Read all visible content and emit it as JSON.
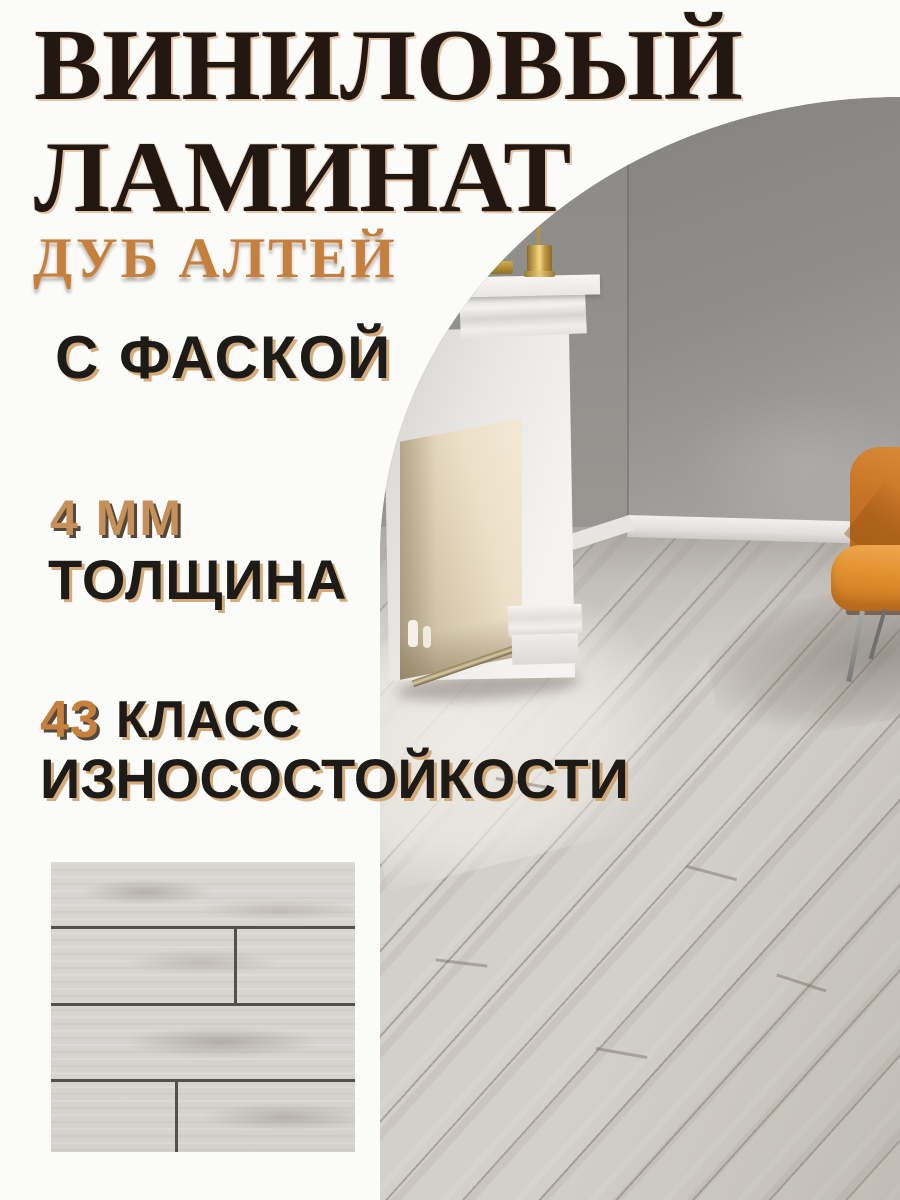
{
  "page": {
    "background": "#fbfbfa"
  },
  "title": {
    "line1": "ВИНИЛОВЫЙ",
    "line2": "ЛАМИНАТ"
  },
  "subtitle": {
    "text": "ДУБ АЛТЕЙ"
  },
  "features": {
    "chamfer": "С ФАСКОЙ",
    "thickness_value": "4 ММ",
    "thickness_label": "ТОЛЩИНА",
    "wear_class_number": "43",
    "wear_class_word": "КЛАСС",
    "wear_class_line2": "ИЗНОСОСТОЙКОСТИ"
  },
  "colors": {
    "accent_orange": "#c6803e",
    "thickness_value_orange": "#c6905a",
    "title_dark": "#231811",
    "text_dark": "#1d1b18",
    "wall_gray": "#8e8c88",
    "floor_light_gray": "#d3cfca",
    "chair_orange": "#d98b36",
    "brass": "#d9b75e"
  },
  "photo": {
    "description": "Room with white classic fireplace, brass candlestick on mantel, orange armchair and light grey oak vinyl flooring"
  },
  "swatch": {
    "description": "Close-up of light grey oak laminate planks with bevelled seams"
  }
}
